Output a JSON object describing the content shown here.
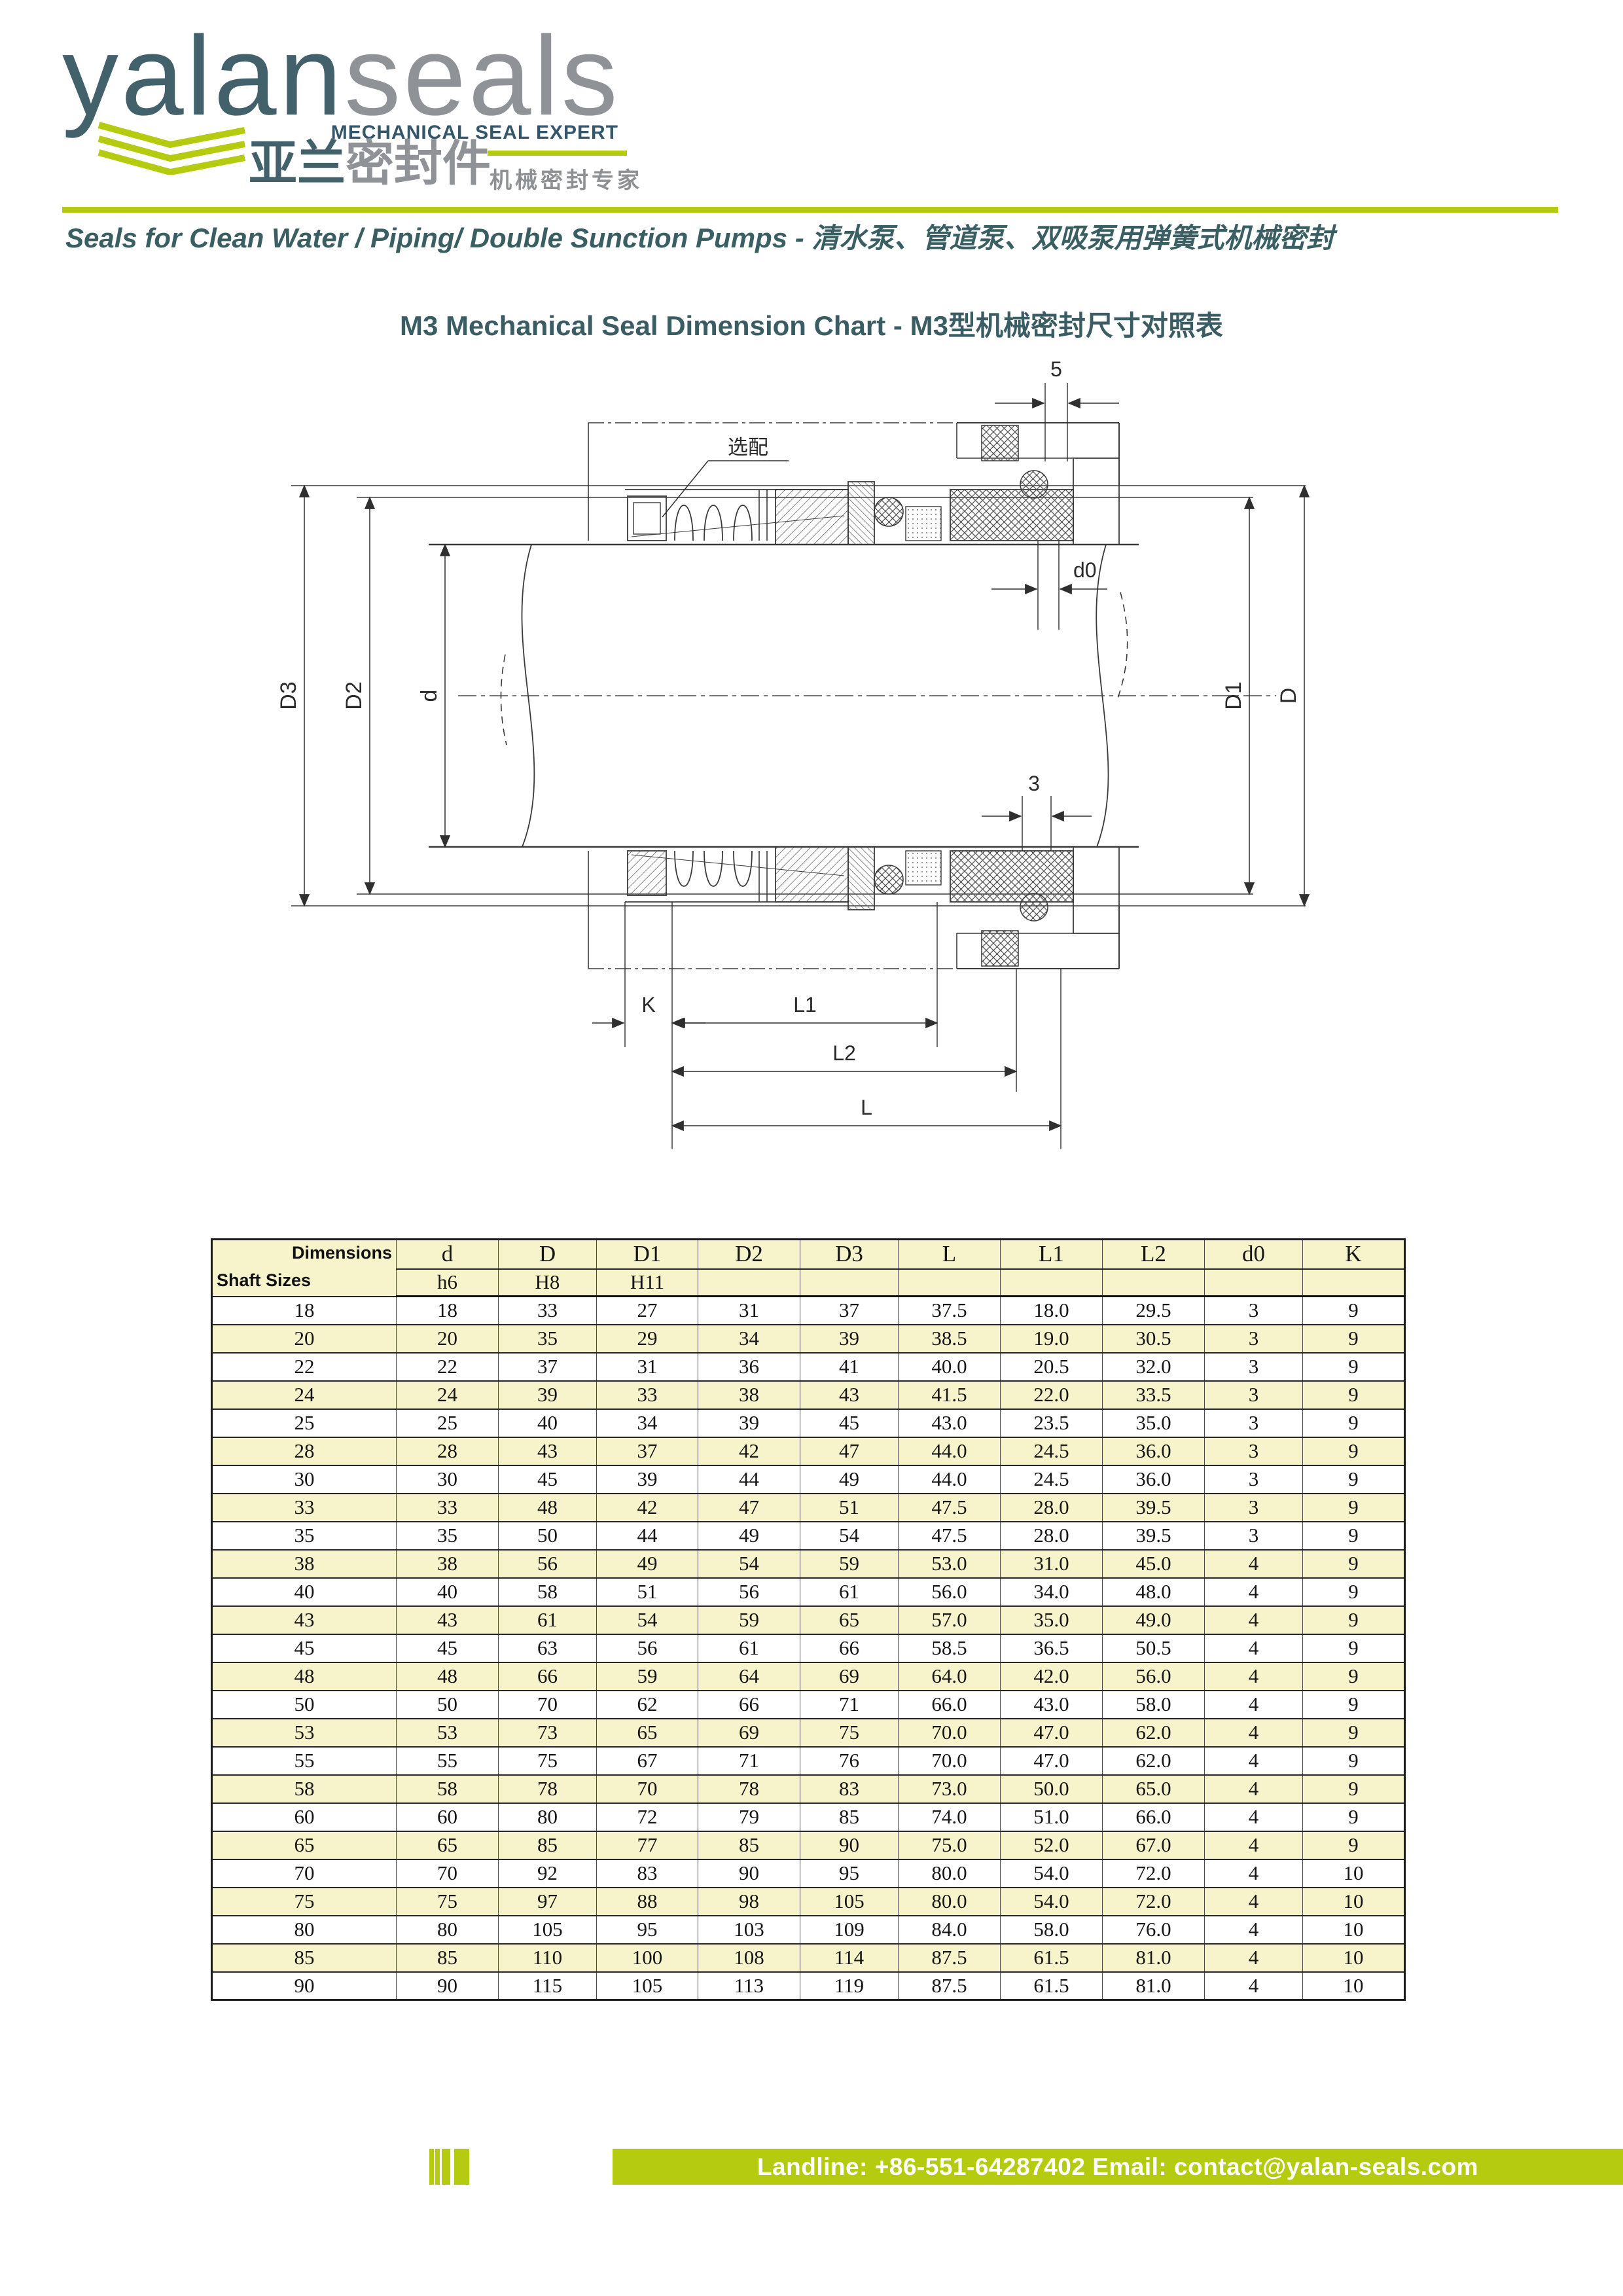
{
  "logo": {
    "brand_primary": "yalan",
    "brand_secondary": "seals",
    "tagline_en": "MECHANICAL SEAL EXPERT",
    "brand_cn_primary": "亚兰",
    "brand_cn_secondary": "密封件",
    "tagline_cn": "机械密封专家"
  },
  "tagline": "Seals for Clean Water / Piping/ Double Sunction Pumps - 清水泵、管道泵、双吸泵用弹簧式机械密封",
  "title": "M3 Mechanical Seal Dimension Chart - M3型机械密封尺寸对照表",
  "drawing": {
    "labels": {
      "D3": "D3",
      "D2": "D2",
      "d": "d",
      "D1": "D1",
      "D": "D",
      "five": "5",
      "d0": "d0",
      "three": "3",
      "K": "K",
      "L1": "L1",
      "L2": "L2",
      "L": "L",
      "optional": "选配"
    }
  },
  "table": {
    "corner_top": "Dimensions",
    "corner_bottom": "Shaft Sizes",
    "columns": [
      "d",
      "D",
      "D1",
      "D2",
      "D3",
      "L",
      "L1",
      "L2",
      "d0",
      "K"
    ],
    "tolerances": [
      "h6",
      "H8",
      "H11",
      "",
      "",
      "",
      "",
      "",
      "",
      ""
    ],
    "rows": [
      [
        "18",
        "18",
        "33",
        "27",
        "31",
        "37",
        "37.5",
        "18.0",
        "29.5",
        "3",
        "9"
      ],
      [
        "20",
        "20",
        "35",
        "29",
        "34",
        "39",
        "38.5",
        "19.0",
        "30.5",
        "3",
        "9"
      ],
      [
        "22",
        "22",
        "37",
        "31",
        "36",
        "41",
        "40.0",
        "20.5",
        "32.0",
        "3",
        "9"
      ],
      [
        "24",
        "24",
        "39",
        "33",
        "38",
        "43",
        "41.5",
        "22.0",
        "33.5",
        "3",
        "9"
      ],
      [
        "25",
        "25",
        "40",
        "34",
        "39",
        "45",
        "43.0",
        "23.5",
        "35.0",
        "3",
        "9"
      ],
      [
        "28",
        "28",
        "43",
        "37",
        "42",
        "47",
        "44.0",
        "24.5",
        "36.0",
        "3",
        "9"
      ],
      [
        "30",
        "30",
        "45",
        "39",
        "44",
        "49",
        "44.0",
        "24.5",
        "36.0",
        "3",
        "9"
      ],
      [
        "33",
        "33",
        "48",
        "42",
        "47",
        "51",
        "47.5",
        "28.0",
        "39.5",
        "3",
        "9"
      ],
      [
        "35",
        "35",
        "50",
        "44",
        "49",
        "54",
        "47.5",
        "28.0",
        "39.5",
        "3",
        "9"
      ],
      [
        "38",
        "38",
        "56",
        "49",
        "54",
        "59",
        "53.0",
        "31.0",
        "45.0",
        "4",
        "9"
      ],
      [
        "40",
        "40",
        "58",
        "51",
        "56",
        "61",
        "56.0",
        "34.0",
        "48.0",
        "4",
        "9"
      ],
      [
        "43",
        "43",
        "61",
        "54",
        "59",
        "65",
        "57.0",
        "35.0",
        "49.0",
        "4",
        "9"
      ],
      [
        "45",
        "45",
        "63",
        "56",
        "61",
        "66",
        "58.5",
        "36.5",
        "50.5",
        "4",
        "9"
      ],
      [
        "48",
        "48",
        "66",
        "59",
        "64",
        "69",
        "64.0",
        "42.0",
        "56.0",
        "4",
        "9"
      ],
      [
        "50",
        "50",
        "70",
        "62",
        "66",
        "71",
        "66.0",
        "43.0",
        "58.0",
        "4",
        "9"
      ],
      [
        "53",
        "53",
        "73",
        "65",
        "69",
        "75",
        "70.0",
        "47.0",
        "62.0",
        "4",
        "9"
      ],
      [
        "55",
        "55",
        "75",
        "67",
        "71",
        "76",
        "70.0",
        "47.0",
        "62.0",
        "4",
        "9"
      ],
      [
        "58",
        "58",
        "78",
        "70",
        "78",
        "83",
        "73.0",
        "50.0",
        "65.0",
        "4",
        "9"
      ],
      [
        "60",
        "60",
        "80",
        "72",
        "79",
        "85",
        "74.0",
        "51.0",
        "66.0",
        "4",
        "9"
      ],
      [
        "65",
        "65",
        "85",
        "77",
        "85",
        "90",
        "75.0",
        "52.0",
        "67.0",
        "4",
        "9"
      ],
      [
        "70",
        "70",
        "92",
        "83",
        "90",
        "95",
        "80.0",
        "54.0",
        "72.0",
        "4",
        "10"
      ],
      [
        "75",
        "75",
        "97",
        "88",
        "98",
        "105",
        "80.0",
        "54.0",
        "72.0",
        "4",
        "10"
      ],
      [
        "80",
        "80",
        "105",
        "95",
        "103",
        "109",
        "84.0",
        "58.0",
        "76.0",
        "4",
        "10"
      ],
      [
        "85",
        "85",
        "110",
        "100",
        "108",
        "114",
        "87.5",
        "61.5",
        "81.0",
        "4",
        "10"
      ],
      [
        "90",
        "90",
        "115",
        "105",
        "113",
        "119",
        "87.5",
        "61.5",
        "81.0",
        "4",
        "10"
      ]
    ]
  },
  "footer": {
    "contact": "Landline: +86-551-64287402  Email: contact@yalan-seals.com"
  },
  "colors": {
    "accent_lime": "#b5cb10",
    "brand_teal": "#42616b",
    "brand_gray": "#8f9296",
    "tagline_navy": "#34566a",
    "heading_teal": "#3a5c63",
    "table_yellow": "#f7f3cb",
    "footer_text": "#ffffff"
  }
}
